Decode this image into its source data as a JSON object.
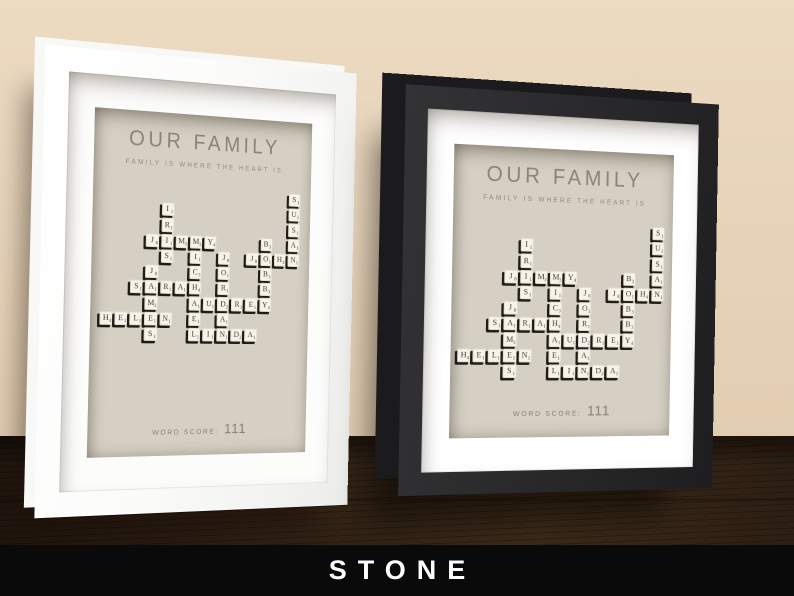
{
  "scene": {
    "wall_color": "#e6d3b9",
    "table_color": "#2c1e13",
    "banner": {
      "label": "STONE",
      "bg_color": "#0a0a0a",
      "text_color": "#ffffff"
    }
  },
  "frames": [
    {
      "id": "white-frame",
      "frame_color": "#ffffff",
      "mat_color": "#fcfcfb"
    },
    {
      "id": "black-frame",
      "frame_color": "#29292b",
      "mat_color": "#ffffff"
    }
  ],
  "artwork": {
    "title": "OUR FAMILY",
    "subtitle": "FAMILY IS WHERE THE HEART IS",
    "score_label": "WORD SCORE:",
    "score_value": "111",
    "background_color": "#d6d0c4",
    "text_color": "#8d8373",
    "names": [
      "IRIS",
      "JIMMY",
      "MICHAEL",
      "SARAH",
      "JAMES",
      "HELEN",
      "AUDREY",
      "JORDAN",
      "LINDA",
      "JOHN",
      "BOBBY",
      "SUSAN"
    ],
    "grid": {
      "cols": 14,
      "rows": 10
    },
    "tile_colors": {
      "face": "#f6f3ea",
      "letter": "#433e34",
      "shadow": "#17130d"
    },
    "tiles": [
      {
        "l": "S",
        "v": 1,
        "c": 13,
        "r": 0
      },
      {
        "l": "I",
        "v": 1,
        "c": 4,
        "r": 1
      },
      {
        "l": "U",
        "v": 1,
        "c": 13,
        "r": 1
      },
      {
        "l": "R",
        "v": 1,
        "c": 4,
        "r": 2
      },
      {
        "l": "S",
        "v": 1,
        "c": 13,
        "r": 2
      },
      {
        "l": "J",
        "v": 8,
        "c": 3,
        "r": 3
      },
      {
        "l": "I",
        "v": 1,
        "c": 4,
        "r": 3
      },
      {
        "l": "M",
        "v": 3,
        "c": 5,
        "r": 3
      },
      {
        "l": "M",
        "v": 3,
        "c": 6,
        "r": 3
      },
      {
        "l": "Y",
        "v": 4,
        "c": 7,
        "r": 3
      },
      {
        "l": "B",
        "v": 3,
        "c": 11,
        "r": 3
      },
      {
        "l": "A",
        "v": 1,
        "c": 13,
        "r": 3
      },
      {
        "l": "S",
        "v": 1,
        "c": 4,
        "r": 4
      },
      {
        "l": "I",
        "v": 1,
        "c": 6,
        "r": 4
      },
      {
        "l": "J",
        "v": 8,
        "c": 8,
        "r": 4
      },
      {
        "l": "J",
        "v": 8,
        "c": 10,
        "r": 4
      },
      {
        "l": "O",
        "v": 1,
        "c": 11,
        "r": 4
      },
      {
        "l": "H",
        "v": 4,
        "c": 12,
        "r": 4
      },
      {
        "l": "N",
        "v": 1,
        "c": 13,
        "r": 4
      },
      {
        "l": "J",
        "v": 8,
        "c": 3,
        "r": 5
      },
      {
        "l": "C",
        "v": 3,
        "c": 6,
        "r": 5
      },
      {
        "l": "O",
        "v": 1,
        "c": 8,
        "r": 5
      },
      {
        "l": "B",
        "v": 3,
        "c": 11,
        "r": 5
      },
      {
        "l": "S",
        "v": 1,
        "c": 2,
        "r": 6
      },
      {
        "l": "A",
        "v": 1,
        "c": 3,
        "r": 6
      },
      {
        "l": "R",
        "v": 1,
        "c": 4,
        "r": 6
      },
      {
        "l": "A",
        "v": 1,
        "c": 5,
        "r": 6
      },
      {
        "l": "H",
        "v": 4,
        "c": 6,
        "r": 6
      },
      {
        "l": "R",
        "v": 1,
        "c": 8,
        "r": 6
      },
      {
        "l": "B",
        "v": 3,
        "c": 11,
        "r": 6
      },
      {
        "l": "M",
        "v": 3,
        "c": 3,
        "r": 7
      },
      {
        "l": "A",
        "v": 1,
        "c": 6,
        "r": 7
      },
      {
        "l": "U",
        "v": 1,
        "c": 7,
        "r": 7
      },
      {
        "l": "D",
        "v": 2,
        "c": 8,
        "r": 7
      },
      {
        "l": "R",
        "v": 1,
        "c": 9,
        "r": 7
      },
      {
        "l": "E",
        "v": 1,
        "c": 10,
        "r": 7
      },
      {
        "l": "Y",
        "v": 4,
        "c": 11,
        "r": 7
      },
      {
        "l": "H",
        "v": 4,
        "c": 0,
        "r": 8
      },
      {
        "l": "E",
        "v": 1,
        "c": 1,
        "r": 8
      },
      {
        "l": "L",
        "v": 1,
        "c": 2,
        "r": 8
      },
      {
        "l": "E",
        "v": 1,
        "c": 3,
        "r": 8
      },
      {
        "l": "N",
        "v": 1,
        "c": 4,
        "r": 8
      },
      {
        "l": "E",
        "v": 1,
        "c": 6,
        "r": 8
      },
      {
        "l": "A",
        "v": 1,
        "c": 8,
        "r": 8
      },
      {
        "l": "S",
        "v": 1,
        "c": 3,
        "r": 9
      },
      {
        "l": "L",
        "v": 1,
        "c": 6,
        "r": 9
      },
      {
        "l": "I",
        "v": 1,
        "c": 7,
        "r": 9
      },
      {
        "l": "N",
        "v": 1,
        "c": 8,
        "r": 9
      },
      {
        "l": "D",
        "v": 2,
        "c": 9,
        "r": 9
      },
      {
        "l": "A",
        "v": 1,
        "c": 10,
        "r": 9
      }
    ]
  }
}
